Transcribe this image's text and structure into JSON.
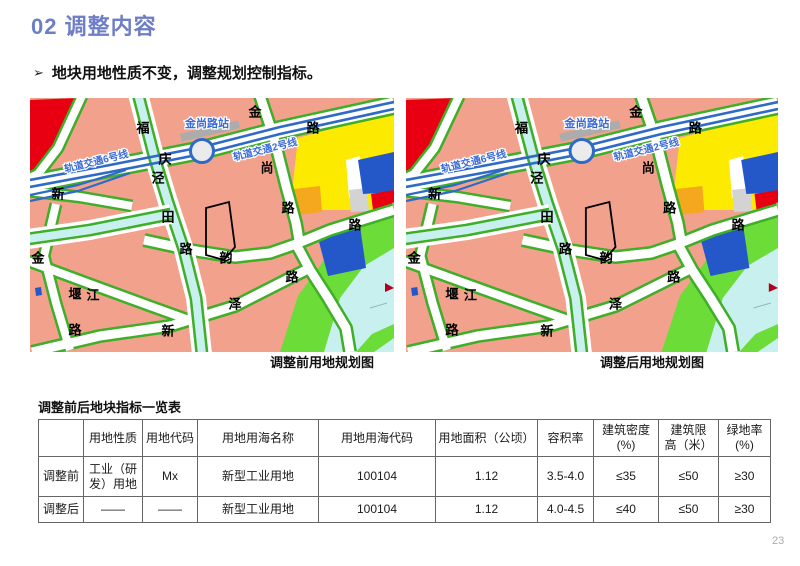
{
  "title": "02 调整内容",
  "bullet": {
    "marker": "➢",
    "text": "地块用地性质不变，调整规划控制指标。"
  },
  "maps": {
    "before": {
      "caption": "调整前用地规划图"
    },
    "after": {
      "caption": "调整后用地规划图"
    },
    "station_label": "金尚路站",
    "line6_label": "轨道交通6号线",
    "line2_label": "轨道交通2号线",
    "road_labels": [
      {
        "text": "福",
        "x": 113,
        "y": 30
      },
      {
        "text": "庆",
        "x": 135,
        "y": 61
      },
      {
        "text": "泾",
        "x": 128,
        "y": 80
      },
      {
        "text": "田",
        "x": 138,
        "y": 119
      },
      {
        "text": "路",
        "x": 156,
        "y": 151
      },
      {
        "text": "韵",
        "x": 196,
        "y": 160
      },
      {
        "text": "金",
        "x": 225,
        "y": 14
      },
      {
        "text": "路",
        "x": 283,
        "y": 30
      },
      {
        "text": "尚",
        "x": 237,
        "y": 70
      },
      {
        "text": "路",
        "x": 258,
        "y": 110
      },
      {
        "text": "路",
        "x": 325,
        "y": 127
      },
      {
        "text": "路",
        "x": 262,
        "y": 179
      },
      {
        "text": "金",
        "x": 8,
        "y": 160
      },
      {
        "text": "堰",
        "x": 45,
        "y": 196
      },
      {
        "text": "江",
        "x": 63,
        "y": 197
      },
      {
        "text": "路",
        "x": 45,
        "y": 232
      },
      {
        "text": "泽",
        "x": 205,
        "y": 206
      },
      {
        "text": "新",
        "x": 138,
        "y": 233
      },
      {
        "text": "新",
        "x": 28,
        "y": 96
      }
    ],
    "colors": {
      "salmon": "#F2A28C",
      "road_green": "#3FAE28",
      "park": "#6CDC38",
      "water": "#C8F0EE",
      "yellow": "#FCEB00",
      "orange": "#F5A81E",
      "blue": "#2458C8",
      "red": "#E80012",
      "gray": "#D3D3D3",
      "metro": "#2E6AC6",
      "label_blue": "#3A6BD8",
      "station_fill": "#EBEBEB",
      "station_bar": "#ACACAC",
      "parcel_outline": "#000000",
      "marker_red": "#B00020"
    }
  },
  "table": {
    "title": "调整前后地块指标一览表",
    "headers": [
      "",
      "用地性质",
      "用地代码",
      "用地用海名称",
      "用地用海代码",
      "用地面积（公顷）",
      "容积率",
      "建筑密度\n(%)",
      "建筑限\n高（米）",
      "绿地率\n(%)"
    ],
    "col_widths": [
      45,
      59,
      55,
      121,
      117,
      102,
      56,
      65,
      60,
      52
    ],
    "rows": [
      [
        "调整前",
        "工业（研\n发）用地",
        "Mx",
        "新型工业用地",
        "100104",
        "1.12",
        "3.5-4.0",
        "≤35",
        "≤50",
        "≥30"
      ],
      [
        "调整后",
        "——",
        "——",
        "新型工业用地",
        "100104",
        "1.12",
        "4.0-4.5",
        "≤40",
        "≤50",
        "≥30"
      ]
    ]
  },
  "page_number": "23"
}
